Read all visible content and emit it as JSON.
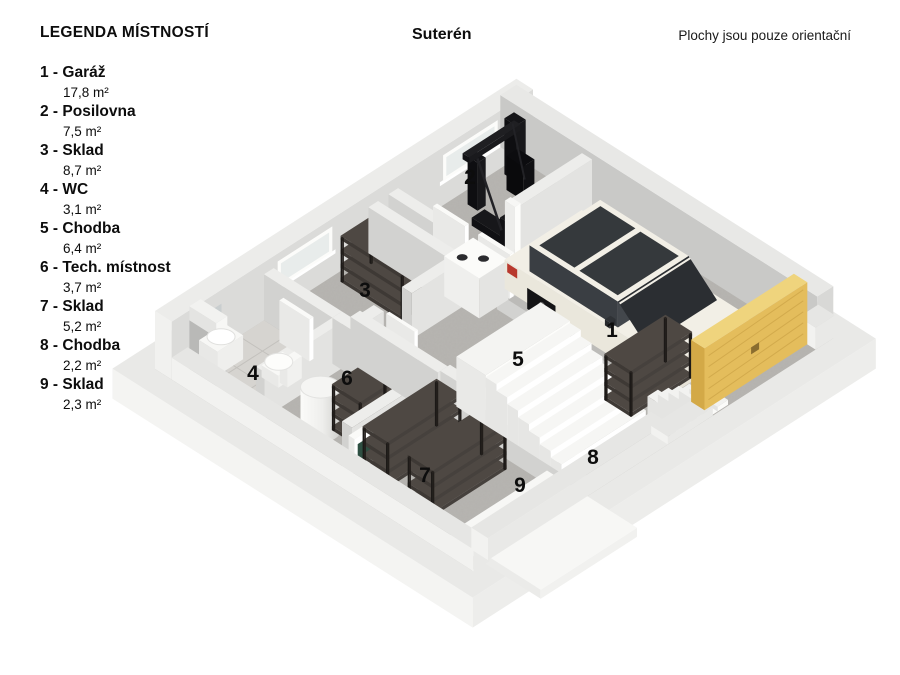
{
  "header": {
    "legend_title": "LEGENDA MÍSTNOSTÍ",
    "plan_title": "Suterén",
    "disclaimer": "Plochy jsou pouze orientační"
  },
  "rooms": [
    {
      "number": "1",
      "name": "Garáž",
      "label": "1 - Garáž",
      "area": "17,8 m²"
    },
    {
      "number": "2",
      "name": "Posilovna",
      "label": "2 - Posilovna",
      "area": "7,5 m²"
    },
    {
      "number": "3",
      "name": "Sklad",
      "label": "3 - Sklad",
      "area": "8,7 m²"
    },
    {
      "number": "4",
      "name": "WC",
      "label": "4 - WC",
      "area": "3,1 m²"
    },
    {
      "number": "5",
      "name": "Chodba",
      "label": "5 - Chodba",
      "area": "6,4 m²"
    },
    {
      "number": "6",
      "name": "Tech. místnost",
      "label": "6 - Tech. místnost",
      "area": "3,7 m²"
    },
    {
      "number": "7",
      "name": "Sklad",
      "label": "7 - Sklad",
      "area": "5,2 m²"
    },
    {
      "number": "8",
      "name": "Chodba",
      "label": "8 - Chodba",
      "area": "2,2 m²"
    },
    {
      "number": "9",
      "name": "Sklad",
      "label": "9 - Sklad",
      "area": "2,3 m²"
    }
  ],
  "colors": {
    "floor": "#b4b2ae",
    "wall_top": "#ededeb",
    "wall_light": "#e3e3e1",
    "wall_side": "#d2d2d0",
    "garage_door": "#e4bd5c",
    "car_body": "#f2efe6",
    "car_glass": "#35393c",
    "shelving": "#4e4843",
    "stairs": "#f6f6f4",
    "label_text": "#0d0d0d"
  }
}
